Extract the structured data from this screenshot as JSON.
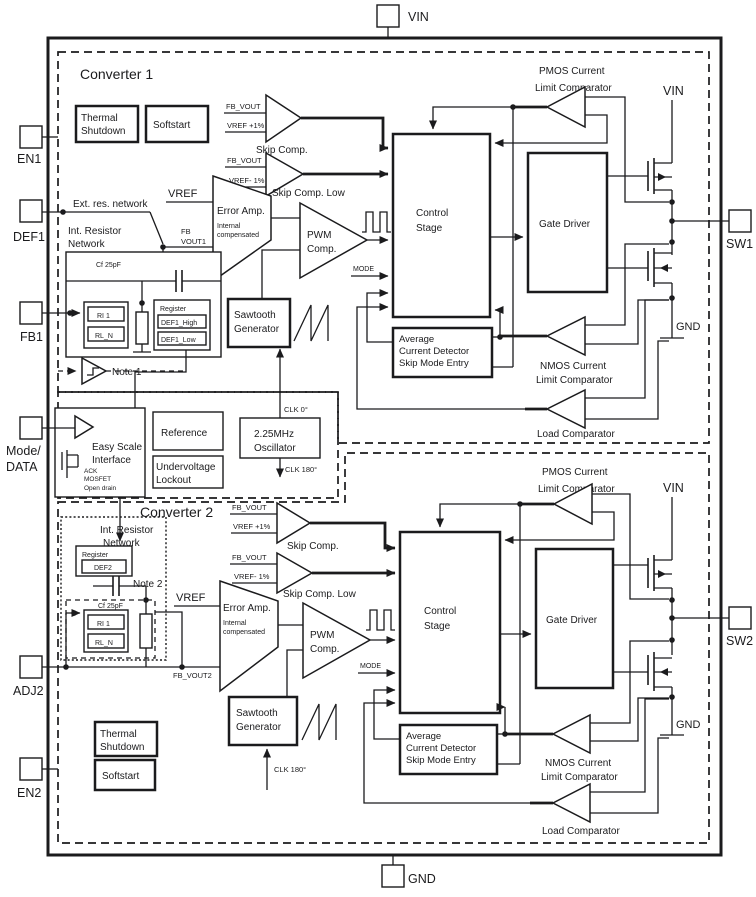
{
  "colors": {
    "ink": "#1b1b1d",
    "background": "#ffffff"
  },
  "pins": {
    "vin": "VIN",
    "gnd": "GND",
    "en1": "EN1",
    "def1": "DEF1",
    "fb1": "FB1",
    "mode1": "Mode/",
    "mode2": "DATA",
    "adj2": "ADJ2",
    "en2": "EN2",
    "sw1": "SW1",
    "sw2": "SW2"
  },
  "labels": {
    "converter1": "Converter 1",
    "converter2": "Converter 2",
    "thermal1": "Thermal",
    "thermal2": "Shutdown",
    "softstart": "Softstart",
    "fb_vout": "FB_VOUT",
    "vref_plus": "VREF +1%",
    "vref_minus": "VREF- 1%",
    "skip_comp": "Skip Comp.",
    "skip_comp_low": "Skip Comp. Low",
    "vref": "VREF",
    "ext_res": "Ext. res. network",
    "int_res1": "Int. Resistor",
    "int_res2": "Network",
    "fb": "FB",
    "vout1": "VOUT1",
    "fb_vout2": "FB_VOUT2",
    "error_amp": "Error Amp.",
    "internal": "Internal",
    "compensated": "compensated",
    "pwm": "PWM",
    "comp": "Comp.",
    "mode": "MODE",
    "control": "Control",
    "stage": "Stage",
    "gate_driver": "Gate Driver",
    "sawtooth": "Sawtooth",
    "generator": "Generator",
    "average": "Average",
    "current_detector": "Current Detector",
    "skip_mode_entry": "Skip Mode Entry",
    "pmos_current": "PMOS Current",
    "nmos_current": "NMOS Current",
    "limit_comparator": "Limit Comparator",
    "load_comparator": "Load Comparator",
    "cap": "Cf 25pF",
    "register": "Register",
    "def1_high": "DEF1_High",
    "def1_low": "DEF1_Low",
    "def2": "DEF2",
    "ri1": "RI 1",
    "rl_n": "RL_N",
    "note1": "Note 1",
    "note2": "Note 2",
    "easy1": "Easy Scale",
    "easy2": "Interface",
    "ack": "ACK",
    "mosfet": "MOSFET",
    "open_drain": "Open drain",
    "reference": "Reference",
    "uvlo1": "Undervoltage",
    "uvlo2": "Lockout",
    "osc1": "2.25MHz",
    "osc2": "Oscillator",
    "clk0": "CLK 0°",
    "clk180": "CLK 180°",
    "vin": "VIN",
    "gnd": "GND"
  }
}
